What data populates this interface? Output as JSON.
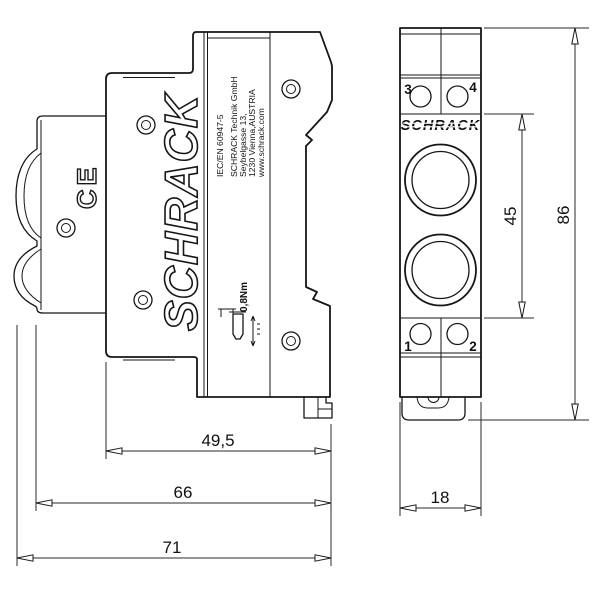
{
  "colors": {
    "background": "#ffffff",
    "line": "#161616"
  },
  "side_view": {
    "logo": "SCHRACK",
    "ce_mark": "CE",
    "label_lines": [
      "IEC/EN 60947-5",
      "SCHRACK Technik GmbH",
      "Seybelgasse 13,",
      "1230 Vienna,AUSTRIA",
      "www.schrack.com"
    ],
    "torque_label": "0,8Nm",
    "dimensions": {
      "front_depth": "49,5",
      "body_depth": "66",
      "total_depth": "71"
    }
  },
  "front_view": {
    "logo": "SCHRACK",
    "terminals": {
      "top_left": "3",
      "top_right": "4",
      "bottom_left": "1",
      "bottom_right": "2"
    },
    "dimensions": {
      "width": "18",
      "lens_section_height": "45",
      "total_height": "86"
    }
  }
}
